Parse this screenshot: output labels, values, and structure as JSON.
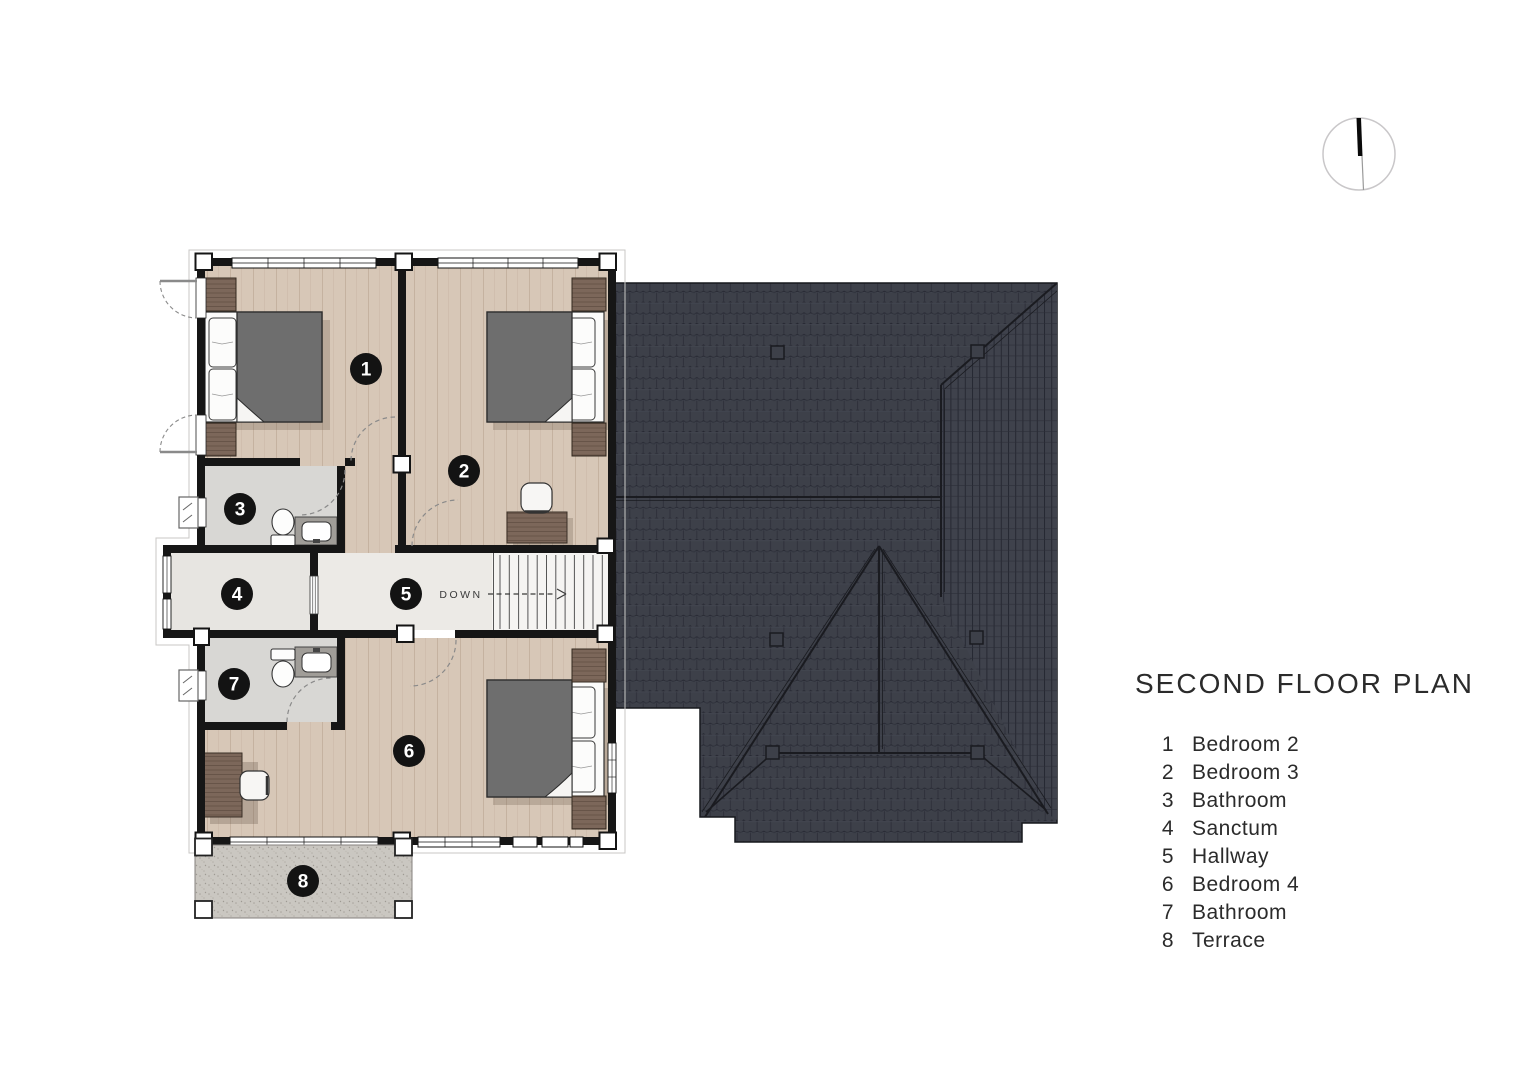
{
  "title": "SECOND FLOOR PLAN",
  "legend": {
    "items": [
      {
        "num": "1",
        "label": "Bedroom 2"
      },
      {
        "num": "2",
        "label": "Bedroom 3"
      },
      {
        "num": "3",
        "label": "Bathroom"
      },
      {
        "num": "4",
        "label": "Sanctum"
      },
      {
        "num": "5",
        "label": "Hallway"
      },
      {
        "num": "6",
        "label": "Bedroom 4"
      },
      {
        "num": "7",
        "label": "Bathroom"
      },
      {
        "num": "8",
        "label": "Terrace"
      }
    ]
  },
  "plan": {
    "down_label": "DOWN",
    "rooms": [
      {
        "number": "1",
        "name": "Bedroom 2"
      },
      {
        "number": "2",
        "name": "Bedroom 3"
      },
      {
        "number": "3",
        "name": "Bathroom"
      },
      {
        "number": "4",
        "name": "Sanctum"
      },
      {
        "number": "5",
        "name": "Hallway"
      },
      {
        "number": "6",
        "name": "Bedroom 4"
      },
      {
        "number": "7",
        "name": "Bathroom"
      },
      {
        "number": "8",
        "name": "Terrace"
      }
    ]
  },
  "colors": {
    "wall": "#161616",
    "floor_wood": "#d7c7b7",
    "floor_bath": "#d8d7d4",
    "floor_hall": "#eceae6",
    "floor_sanctum": "#e7e5e1",
    "roof": "#3d4049",
    "roof_line": "#262832",
    "furniture_wood": "#7c675a",
    "mattress": "#6e6e6e",
    "terrace": "#cac7c1",
    "badge": "#131313"
  }
}
